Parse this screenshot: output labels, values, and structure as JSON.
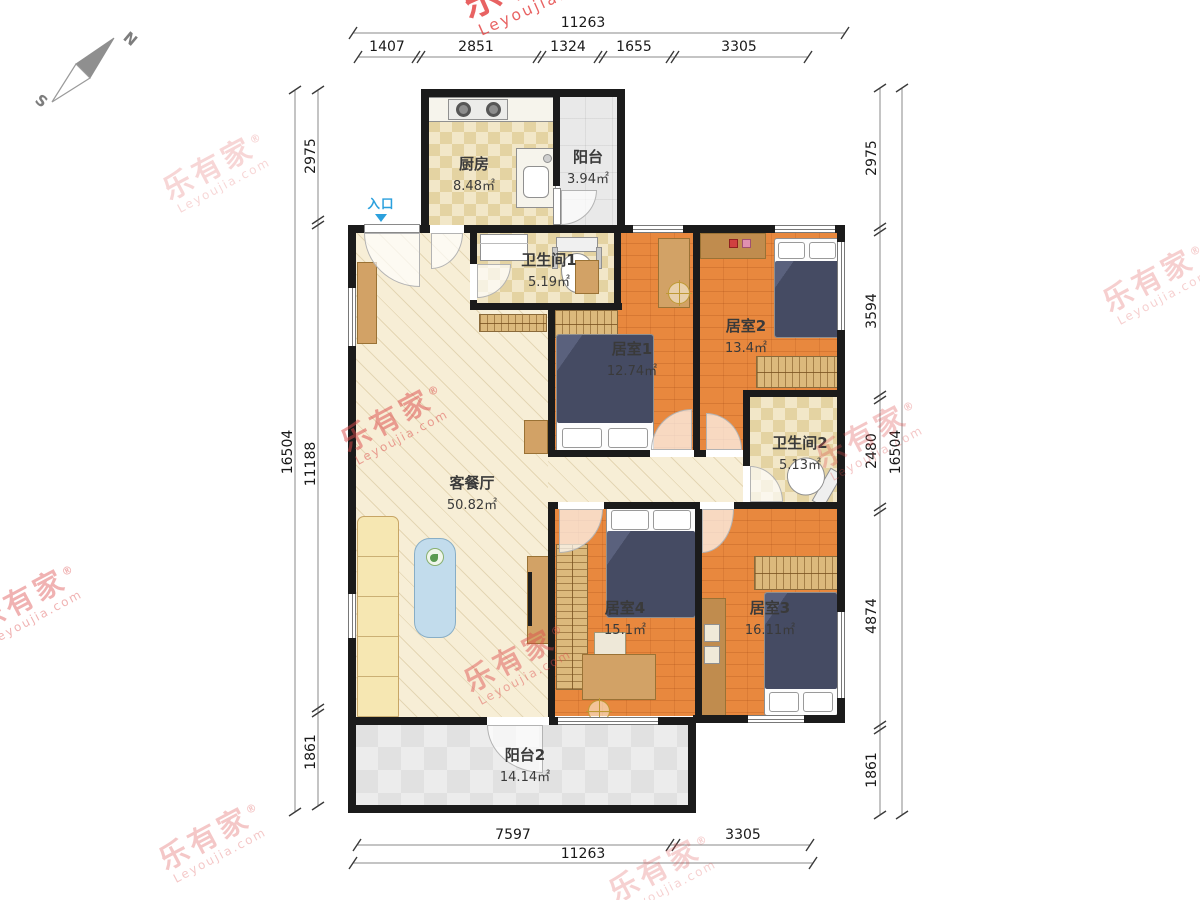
{
  "watermark": {
    "text": "乐有家",
    "registered": "®",
    "subtext": "Leyoujia.com"
  },
  "compass": {
    "north_label": "N",
    "south_label": "S"
  },
  "entrance": {
    "label": "入口"
  },
  "rooms": {
    "kitchen": {
      "name": "厨房",
      "area": "8.48㎡"
    },
    "balcony1": {
      "name": "阳台",
      "area": "3.94㎡"
    },
    "bathroom1": {
      "name": "卫生间1",
      "area": "5.19㎡"
    },
    "bedroom1": {
      "name": "居室1",
      "area": "12.74㎡"
    },
    "bedroom2": {
      "name": "居室2",
      "area": "13.4㎡"
    },
    "bathroom2": {
      "name": "卫生间2",
      "area": "5.13㎡"
    },
    "living": {
      "name": "客餐厅",
      "area": "50.82㎡"
    },
    "bedroom4": {
      "name": "居室4",
      "area": "15.1㎡"
    },
    "bedroom3": {
      "name": "居室3",
      "area": "16.11㎡"
    },
    "balcony2": {
      "name": "阳台2",
      "area": "14.14㎡"
    }
  },
  "dimensions": {
    "top": {
      "overall": "11263",
      "segments": [
        "1407",
        "2851",
        "1324",
        "1655",
        "3305"
      ]
    },
    "bottom": {
      "overall": "11263",
      "segments": [
        "7597",
        "3305"
      ]
    },
    "left": {
      "overall": "16504",
      "segments": [
        "2975",
        "11188",
        "1861"
      ]
    },
    "right": {
      "overall": "16504",
      "segments": [
        "2975",
        "3594",
        "2480",
        "4874",
        "1861"
      ]
    }
  },
  "colors": {
    "wall": "#1b1b1b",
    "wood_floor": "#e8883e",
    "living_floor": "#f7eed6",
    "tile_floor": "#f1e5c2",
    "balcony_floor": "#e9e9e9",
    "watermark_red": "#dd4a4a",
    "entrance_blue": "#2ba0dd",
    "bed": "#454b63",
    "wardrobe": "#dcb97c",
    "sofa": "#f6e7b2"
  }
}
